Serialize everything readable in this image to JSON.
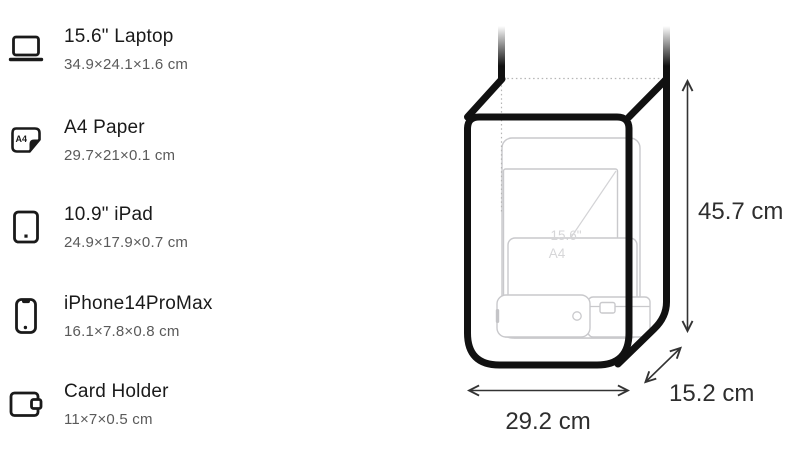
{
  "items": [
    {
      "title": "15.6\" Laptop",
      "dims": "34.9×24.1×1.6 cm",
      "icon": "laptop-icon"
    },
    {
      "title": "A4 Paper",
      "dims": "29.7×21×0.1 cm",
      "icon": "a4-paper-icon",
      "icon_label": "A4"
    },
    {
      "title": "10.9\" iPad",
      "dims": "24.9×17.9×0.7 cm",
      "icon": "ipad-icon"
    },
    {
      "title": "iPhone14ProMax",
      "dims": "16.1×7.8×0.8 cm",
      "icon": "iphone-icon"
    },
    {
      "title": "Card Holder",
      "dims": "11×7×0.5 cm",
      "icon": "card-holder-icon"
    }
  ],
  "diagram": {
    "height_label": "45.7 cm",
    "width_label": "29.2 cm",
    "depth_label": "15.2 cm",
    "watermark_laptop": "15.6\"",
    "watermark_a4": "A4",
    "colors": {
      "bag_outline": "#111111",
      "inner_item_outline": "#c9c9cc",
      "dimension_text": "#2e2e2e",
      "watermark_text": "#d6d6d8",
      "title_text": "#1a1a1a",
      "subtitle_text": "#5a5a5a"
    }
  }
}
